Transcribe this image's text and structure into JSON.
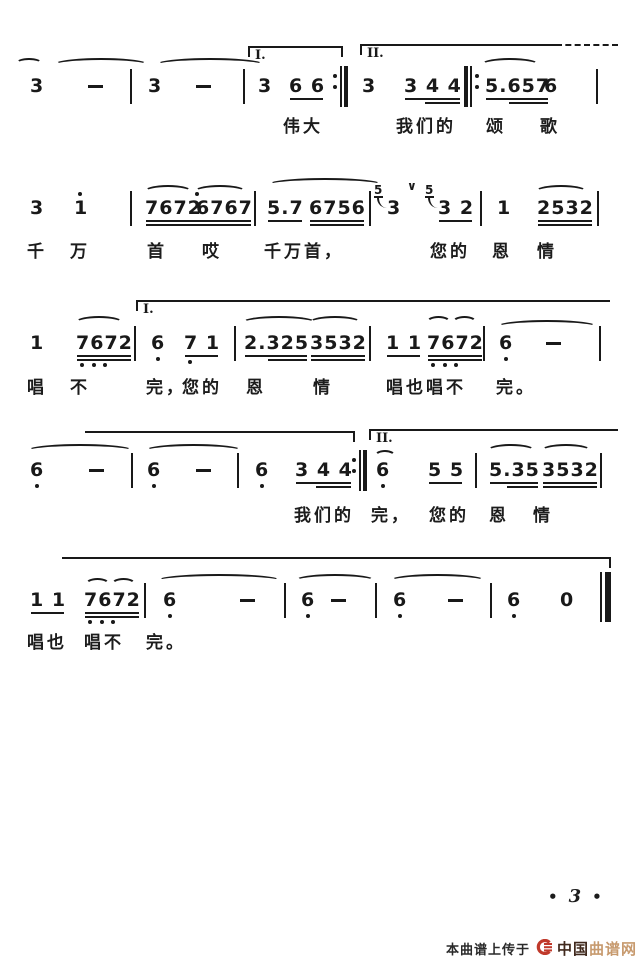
{
  "page": {
    "dot": "•",
    "number": "3"
  },
  "footer": {
    "watermark_prefix": "本曲谱上传于",
    "brand_cn": "中国",
    "brand_tan": "曲谱网",
    "logo_color": "#c0392b"
  },
  "colors": {
    "ink": "#191919",
    "background": "#ffffff"
  },
  "score": {
    "systems": [
      {
        "noteY": 76,
        "slurY": 58,
        "lyricY": 112,
        "brackets": [
          {
            "label": "I.",
            "x": 248,
            "w": 95,
            "y": 46,
            "hookL": true,
            "hookR": true
          },
          {
            "label": "II.",
            "x": 360,
            "w": 196,
            "y": 44,
            "hookL": true,
            "dashTail": 62
          }
        ],
        "slurs": [
          {
            "x": 16,
            "w": 26,
            "h": 10
          },
          {
            "x": 54,
            "w": 94
          },
          {
            "x": 156,
            "w": 108
          },
          {
            "x": 481,
            "w": 58
          }
        ],
        "tokens": [
          {
            "k": "note",
            "t": "3",
            "x": 30
          },
          {
            "k": "dash",
            "x": 88
          },
          {
            "k": "bar",
            "x": 130
          },
          {
            "k": "note",
            "t": "3",
            "x": 148
          },
          {
            "k": "dash",
            "x": 196
          },
          {
            "k": "bar",
            "x": 243
          },
          {
            "k": "note",
            "t": "3",
            "x": 258
          },
          {
            "k": "group",
            "t": "6 6",
            "u": 1,
            "x": 289
          },
          {
            "k": "bar",
            "style": "repeat-end",
            "x": 333
          },
          {
            "k": "note",
            "t": "3",
            "x": 362
          },
          {
            "k": "group",
            "t": "3 4 4",
            "u": 2,
            "u2p": true,
            "x": 404
          },
          {
            "k": "bar",
            "style": "repeat-begin",
            "x": 464
          },
          {
            "k": "group",
            "t": "5.657",
            "u": 2,
            "u2p": true,
            "x": 485
          },
          {
            "k": "note",
            "t": "6",
            "x": 544
          },
          {
            "k": "bar",
            "x": 596
          }
        ],
        "lyrics": [
          {
            "t": "伟大",
            "x": 283
          },
          {
            "t": "我们的",
            "x": 396
          },
          {
            "t": "颂",
            "x": 486
          },
          {
            "t": "歌",
            "x": 540
          }
        ]
      },
      {
        "noteY": 198,
        "slurY": 182,
        "lyricY": 237,
        "brackets": [],
        "slurs": [
          {
            "x": 144,
            "w": 48,
            "y": 185
          },
          {
            "x": 194,
            "w": 52,
            "y": 185
          },
          {
            "x": 268,
            "w": 114,
            "y": 178
          },
          {
            "x": 535,
            "w": 52,
            "y": 185
          }
        ],
        "tokens": [
          {
            "k": "note",
            "t": "3",
            "x": 30
          },
          {
            "k": "note",
            "t": "1",
            "x": 74,
            "dotAbove": true
          },
          {
            "k": "bar",
            "x": 130
          },
          {
            "k": "group",
            "t": "7672",
            "u": 2,
            "x": 145,
            "dotAboveLast": true
          },
          {
            "k": "group",
            "t": "6767",
            "u": 2,
            "x": 196
          },
          {
            "k": "bar",
            "x": 254
          },
          {
            "k": "group",
            "t": "5.7",
            "u": 1,
            "x": 267
          },
          {
            "k": "group",
            "t": "6756",
            "u": 2,
            "x": 309
          },
          {
            "k": "bar",
            "x": 369
          },
          {
            "k": "grace",
            "g": "5",
            "x": 374
          },
          {
            "k": "note",
            "t": "3",
            "x": 387
          },
          {
            "k": "breath",
            "x": 407
          },
          {
            "k": "grace",
            "g": "5",
            "x": 425
          },
          {
            "k": "group",
            "t": "3 2",
            "u": 1,
            "x": 438
          },
          {
            "k": "bar",
            "x": 480
          },
          {
            "k": "note",
            "t": "1",
            "x": 497
          },
          {
            "k": "group",
            "t": "2532",
            "u": 2,
            "x": 537
          },
          {
            "k": "bar",
            "x": 597
          }
        ],
        "lyrics": [
          {
            "t": "千",
            "x": 27
          },
          {
            "t": "万",
            "x": 70
          },
          {
            "t": "首",
            "x": 147
          },
          {
            "t": "哎",
            "x": 202
          },
          {
            "t": "千万首，",
            "x": 264
          },
          {
            "t": "您的",
            "x": 430
          },
          {
            "t": "恩",
            "x": 492
          },
          {
            "t": "情",
            "x": 537
          }
        ]
      },
      {
        "noteY": 333,
        "slurY": 316,
        "lyricY": 373,
        "brackets": [
          {
            "label": "I.",
            "x": 136,
            "w": 474,
            "y": 300,
            "hookL": true
          }
        ],
        "slurs": [
          {
            "x": 75,
            "w": 48
          },
          {
            "x": 242,
            "w": 74
          },
          {
            "x": 309,
            "w": 52
          },
          {
            "x": 426,
            "w": 25
          },
          {
            "x": 452,
            "w": 25
          },
          {
            "x": 497,
            "w": 100,
            "y": 320
          }
        ],
        "tokens": [
          {
            "k": "note",
            "t": "1",
            "x": 30
          },
          {
            "k": "group",
            "t": "7672",
            "u": 2,
            "x": 76,
            "dotsBelow": [
              0,
              1,
              2
            ]
          },
          {
            "k": "bar",
            "x": 134
          },
          {
            "k": "note",
            "t": "6",
            "x": 151,
            "dotBelow": true
          },
          {
            "k": "group",
            "t": "7 1",
            "u": 1,
            "x": 184,
            "dotsBelow": [
              0
            ]
          },
          {
            "k": "bar",
            "x": 234
          },
          {
            "k": "group",
            "t": "2.325",
            "u": 2,
            "u2p": true,
            "x": 244
          },
          {
            "k": "group",
            "t": "3532",
            "u": 2,
            "x": 310
          },
          {
            "k": "bar",
            "x": 369
          },
          {
            "k": "group",
            "t": "1 1",
            "u": 1,
            "x": 386
          },
          {
            "k": "group",
            "t": "7672",
            "u": 2,
            "x": 427,
            "dotsBelow": [
              0,
              1,
              2
            ]
          },
          {
            "k": "bar",
            "x": 483
          },
          {
            "k": "note",
            "t": "6",
            "x": 499,
            "dotBelow": true
          },
          {
            "k": "dash",
            "x": 546
          },
          {
            "k": "bar",
            "x": 599
          }
        ],
        "lyrics": [
          {
            "t": "唱",
            "x": 27
          },
          {
            "t": "不",
            "x": 70
          },
          {
            "t": "完，",
            "x": 146
          },
          {
            "t": "您的",
            "x": 182
          },
          {
            "t": "恩",
            "x": 246
          },
          {
            "t": "情",
            "x": 313
          },
          {
            "t": "唱也唱不",
            "x": 386
          },
          {
            "t": "完。",
            "x": 496
          }
        ]
      },
      {
        "noteY": 460,
        "slurY": 444,
        "lyricY": 501,
        "brackets": [
          {
            "x": 85,
            "w": 270,
            "y": 431,
            "hookR": true
          },
          {
            "label": "II.",
            "x": 369,
            "w": 249,
            "y": 429,
            "hookL": true
          }
        ],
        "slurs": [
          {
            "x": 27,
            "w": 106
          },
          {
            "x": 145,
            "w": 97
          },
          {
            "x": 374,
            "w": 22,
            "y": 450
          },
          {
            "x": 487,
            "w": 48
          },
          {
            "x": 541,
            "w": 50
          }
        ],
        "tokens": [
          {
            "k": "note",
            "t": "6",
            "x": 30,
            "dotBelow": true
          },
          {
            "k": "dash",
            "x": 89
          },
          {
            "k": "bar",
            "x": 131
          },
          {
            "k": "note",
            "t": "6",
            "x": 147,
            "dotBelow": true
          },
          {
            "k": "dash",
            "x": 196
          },
          {
            "k": "bar",
            "x": 237
          },
          {
            "k": "note",
            "t": "6",
            "x": 255,
            "dotBelow": true
          },
          {
            "k": "group",
            "t": "3 4 4",
            "u": 2,
            "u2p": true,
            "x": 295
          },
          {
            "k": "bar",
            "style": "repeat-end",
            "x": 352
          },
          {
            "k": "note",
            "t": "6",
            "x": 376,
            "dotBelow": true
          },
          {
            "k": "group",
            "t": "5 5",
            "u": 1,
            "x": 428
          },
          {
            "k": "bar",
            "x": 475
          },
          {
            "k": "group",
            "t": "5.35",
            "u": 2,
            "u2p": true,
            "x": 489
          },
          {
            "k": "group",
            "t": "3532",
            "u": 2,
            "x": 542
          },
          {
            "k": "bar",
            "x": 600
          }
        ],
        "lyrics": [
          {
            "t": "我们的",
            "x": 294
          },
          {
            "t": "完，",
            "x": 371
          },
          {
            "t": "您的",
            "x": 429
          },
          {
            "t": "恩",
            "x": 489
          },
          {
            "t": "情",
            "x": 533
          }
        ]
      },
      {
        "noteY": 590,
        "slurY": 574,
        "lyricY": 628,
        "brackets": [
          {
            "x": 62,
            "w": 549,
            "y": 557,
            "hookR": true
          }
        ],
        "slurs": [
          {
            "x": 85,
            "w": 25,
            "y": 578
          },
          {
            "x": 111,
            "w": 25,
            "y": 578
          },
          {
            "x": 157,
            "w": 124
          },
          {
            "x": 295,
            "w": 80
          },
          {
            "x": 390,
            "w": 95
          }
        ],
        "tokens": [
          {
            "k": "group",
            "t": "1 1",
            "u": 1,
            "x": 30
          },
          {
            "k": "group",
            "t": "7672",
            "u": 2,
            "x": 84,
            "dotsBelow": [
              0,
              1,
              2
            ]
          },
          {
            "k": "bar",
            "x": 144
          },
          {
            "k": "note",
            "t": "6",
            "x": 163,
            "dotBelow": true
          },
          {
            "k": "dash",
            "x": 240
          },
          {
            "k": "bar",
            "x": 284
          },
          {
            "k": "note",
            "t": "6",
            "x": 301,
            "dotBelow": true
          },
          {
            "k": "dash",
            "x": 331
          },
          {
            "k": "bar",
            "x": 375
          },
          {
            "k": "note",
            "t": "6",
            "x": 393,
            "dotBelow": true
          },
          {
            "k": "dash",
            "x": 448
          },
          {
            "k": "bar",
            "x": 490
          },
          {
            "k": "note",
            "t": "6",
            "x": 507,
            "dotBelow": true
          },
          {
            "k": "note",
            "t": "0",
            "x": 560
          },
          {
            "k": "bar",
            "style": "final",
            "x": 600
          }
        ],
        "lyrics": [
          {
            "t": "唱也",
            "x": 27
          },
          {
            "t": "唱不",
            "x": 84
          },
          {
            "t": "完。",
            "x": 146
          }
        ]
      }
    ]
  }
}
